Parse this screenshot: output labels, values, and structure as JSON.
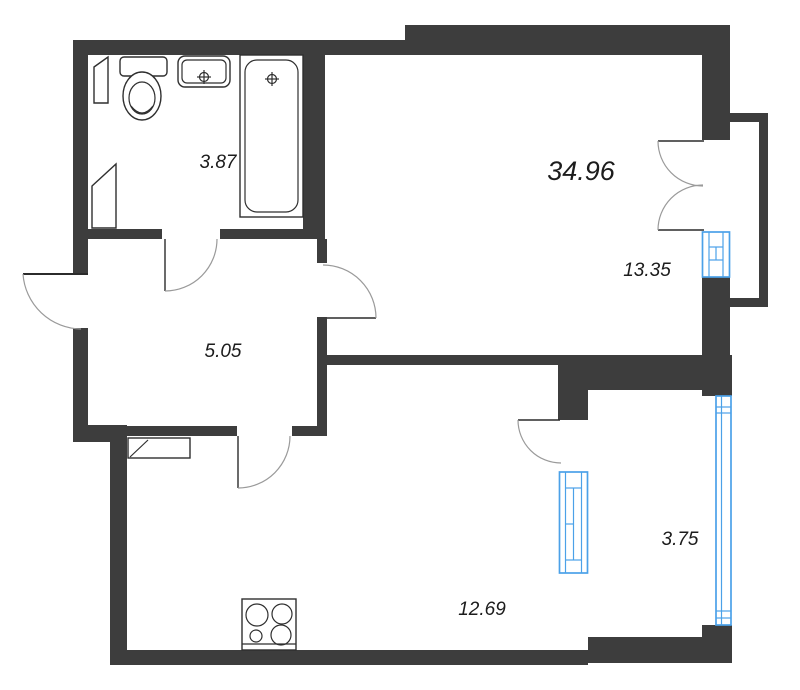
{
  "plan": {
    "type": "apartment-floor-plan",
    "rooms": [
      {
        "name": "bathroom",
        "area_label": "3.87"
      },
      {
        "name": "apartment-total",
        "area_label": "34.96"
      },
      {
        "name": "living-room",
        "area_label": "13.35"
      },
      {
        "name": "hallway",
        "area_label": "5.05"
      },
      {
        "name": "loggia",
        "area_label": "3.75"
      },
      {
        "name": "kitchen-living",
        "area_label": "12.69"
      }
    ],
    "fixtures": [
      "toilet",
      "sink",
      "bathtub",
      "stove-burners",
      "duct-shaft",
      "hall-cabinet"
    ],
    "openings": [
      "entrance-door",
      "bathroom-door",
      "living-room-door",
      "kitchen-door",
      "balcony-double-door",
      "loggia-door",
      "living-room-window",
      "kitchen-window",
      "loggia-glazing"
    ]
  },
  "colors": {
    "wall": "#3d3d3d",
    "window_frame": "#4ba1e8",
    "fixture_line": "#2f2f2f",
    "door_arc": "#9a9a9a",
    "background": "#ffffff"
  }
}
